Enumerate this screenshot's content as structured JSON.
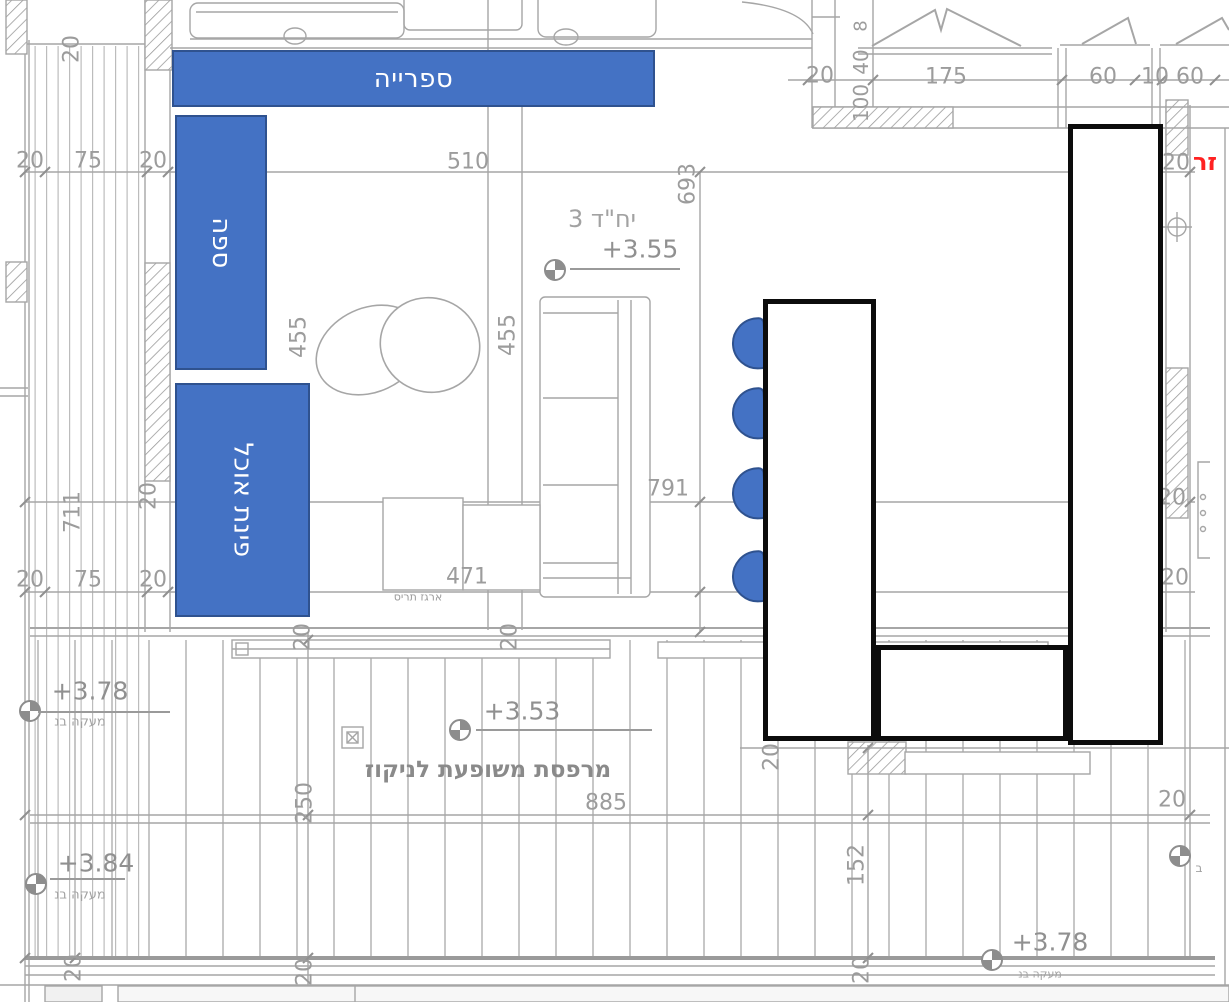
{
  "plan_type": "architectural-floor-plan-with-furniture-annotations",
  "colors": {
    "annotation_blue": "#4472c4",
    "annotation_border": "#2f528f",
    "shape_outline_black": "#0c0c0c",
    "line_gray": "#a6a6a6",
    "text_gray": "#9c9c9c",
    "red_note": "#ff2222"
  },
  "overlays": {
    "library": {
      "label": "ספרייה",
      "x": 172,
      "y": 50,
      "w": 483,
      "h": 57,
      "vertical": false
    },
    "sofa": {
      "label": "ספה",
      "x": 175,
      "y": 115,
      "w": 92,
      "h": 255,
      "vertical": true
    },
    "dining": {
      "label": "פינת אוכל",
      "x": 175,
      "y": 383,
      "w": 135,
      "h": 234,
      "vertical": true
    }
  },
  "tables": [
    {
      "id": "dining-table-left",
      "x": 763,
      "y": 299,
      "w": 113,
      "h": 442
    },
    {
      "id": "dining-table-bottom",
      "x": 876,
      "y": 645,
      "w": 192,
      "h": 96
    },
    {
      "id": "tall-cabinet-right",
      "x": 1068,
      "y": 124,
      "w": 95,
      "h": 621
    }
  ],
  "chairs": {
    "w": 34,
    "h": 52,
    "items": [
      {
        "x": 732,
        "y": 318
      },
      {
        "x": 732,
        "y": 388
      },
      {
        "x": 732,
        "y": 468
      },
      {
        "x": 732,
        "y": 551
      }
    ]
  },
  "dim_labels": [
    {
      "t": "510",
      "x": 468,
      "y": 162
    },
    {
      "t": "693",
      "x": 688,
      "y": 184,
      "r": 1
    },
    {
      "t": "455",
      "x": 299,
      "y": 337,
      "r": 1
    },
    {
      "t": "455",
      "x": 508,
      "y": 335,
      "r": 1
    },
    {
      "t": "791",
      "x": 668,
      "y": 489
    },
    {
      "t": "471",
      "x": 467,
      "y": 577
    },
    {
      "t": "20",
      "x": 30,
      "y": 161
    },
    {
      "t": "75",
      "x": 88,
      "y": 161
    },
    {
      "t": "20",
      "x": 153,
      "y": 161
    },
    {
      "t": "20",
      "x": 30,
      "y": 580
    },
    {
      "t": "75",
      "x": 88,
      "y": 580
    },
    {
      "t": "20",
      "x": 153,
      "y": 580
    },
    {
      "t": "711",
      "x": 73,
      "y": 512,
      "r": 1
    },
    {
      "t": "20",
      "x": 72,
      "y": 49,
      "r": 1
    },
    {
      "t": "20",
      "x": 149,
      "y": 496,
      "r": 1
    },
    {
      "t": "20",
      "x": 303,
      "y": 637,
      "r": 1
    },
    {
      "t": "20",
      "x": 510,
      "y": 637,
      "r": 1
    },
    {
      "t": "20",
      "x": 772,
      "y": 757,
      "r": 1
    },
    {
      "t": "250",
      "x": 305,
      "y": 803,
      "r": 1
    },
    {
      "t": "20",
      "x": 305,
      "y": 972,
      "r": 1
    },
    {
      "t": "20",
      "x": 74,
      "y": 968,
      "r": 1
    },
    {
      "t": "20",
      "x": 862,
      "y": 970,
      "r": 1
    },
    {
      "t": "885",
      "x": 606,
      "y": 803
    },
    {
      "t": "152",
      "x": 857,
      "y": 865,
      "r": 1
    },
    {
      "t": "20",
      "x": 1172,
      "y": 800
    },
    {
      "t": "20",
      "x": 1176,
      "y": 163
    },
    {
      "t": "20",
      "x": 1172,
      "y": 498
    },
    {
      "t": "20",
      "x": 1175,
      "y": 578
    },
    {
      "t": "20",
      "x": 820,
      "y": 76
    },
    {
      "t": "175",
      "x": 946,
      "y": 77
    },
    {
      "t": "60",
      "x": 1103,
      "y": 77
    },
    {
      "t": "10",
      "x": 1155,
      "y": 77
    },
    {
      "t": "60",
      "x": 1190,
      "y": 77
    },
    {
      "t": "8",
      "x": 861,
      "y": 26,
      "r": 1,
      "fs": 18
    },
    {
      "t": "40",
      "x": 861,
      "y": 62,
      "r": 1,
      "fs": 20
    },
    {
      "t": "100",
      "x": 861,
      "y": 103,
      "r": 1,
      "fs": 20
    }
  ],
  "levels": [
    {
      "v": "+3.55",
      "cx": 555,
      "cy": 270,
      "tx": 640,
      "ty": 249,
      "l": [
        570,
        680,
        268
      ],
      "note": "יח\"ד 3",
      "nx": 602,
      "ny": 219,
      "nfs": 24
    },
    {
      "v": "+3.53",
      "cx": 460,
      "cy": 730,
      "tx": 522,
      "ty": 711,
      "l": [
        476,
        652,
        729
      ]
    },
    {
      "v": "+3.78",
      "cx": 30,
      "cy": 711,
      "tx": 90,
      "ty": 691,
      "l": [
        38,
        170,
        711
      ],
      "note": "מעקה בנ",
      "nx": 80,
      "ny": 722,
      "nfs": 13
    },
    {
      "v": "+3.84",
      "cx": 36,
      "cy": 884,
      "tx": 96,
      "ty": 863,
      "l": [
        50,
        125,
        878
      ],
      "note": "מעקה בנ",
      "nx": 80,
      "ny": 895,
      "nfs": 13
    },
    {
      "v": "+3.78",
      "cx": 992,
      "cy": 960,
      "tx": 1050,
      "ty": 942,
      "l": [
        1005,
        1090,
        958
      ],
      "note": "מעקה בנ",
      "nx": 1040,
      "ny": 974,
      "nfs": 11
    },
    {
      "v": "",
      "cx": 1180,
      "cy": 856,
      "note": "ב",
      "nx": 1199,
      "ny": 868,
      "nfs": 12
    }
  ],
  "texts": [
    {
      "id": "balcony-label",
      "t": "מרפסת משופעת לניקוז",
      "x": 488,
      "y": 770,
      "fs": 23,
      "c": "#8a8a8a",
      "b": 1
    },
    {
      "id": "shutter-box-label",
      "t": "ארגז תריס",
      "x": 418,
      "y": 597,
      "fs": 11,
      "c": "#9a9a9a"
    },
    {
      "id": "red-edge-note",
      "t": "זר",
      "x": 1205,
      "y": 162,
      "fs": 24,
      "c": "#ff2222",
      "b": 1
    }
  ]
}
